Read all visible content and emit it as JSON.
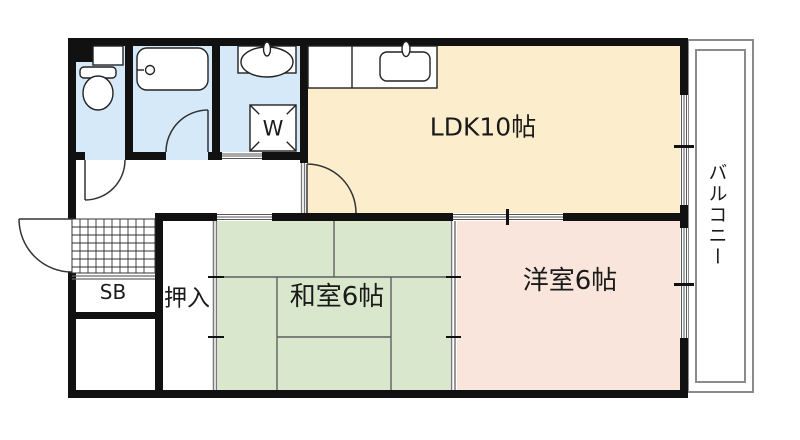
{
  "rooms": {
    "ldk": {
      "label": "LDK10帖",
      "color": "#fcedcd"
    },
    "washitsu": {
      "label": "和室6帖",
      "color": "#d9e7cc"
    },
    "yoshitsu": {
      "label": "洋室6帖",
      "color": "#fae5dc"
    },
    "balcony": {
      "label": "バルコニー"
    },
    "oshiire": {
      "label": "押入"
    },
    "shoebox": {
      "label": "SB"
    },
    "washer": {
      "label": "W"
    },
    "toilet": {
      "color": "#d6e9f8"
    },
    "bathroom": {
      "color": "#d6e9f8"
    },
    "washroom": {
      "color": "#d6e9f8"
    }
  },
  "colors": {
    "wall": "#111111",
    "balcony_rail": "#8a8a8a",
    "window_line": "#555555",
    "tatami_line": "#5f5f5f",
    "door_line": "#333333"
  }
}
